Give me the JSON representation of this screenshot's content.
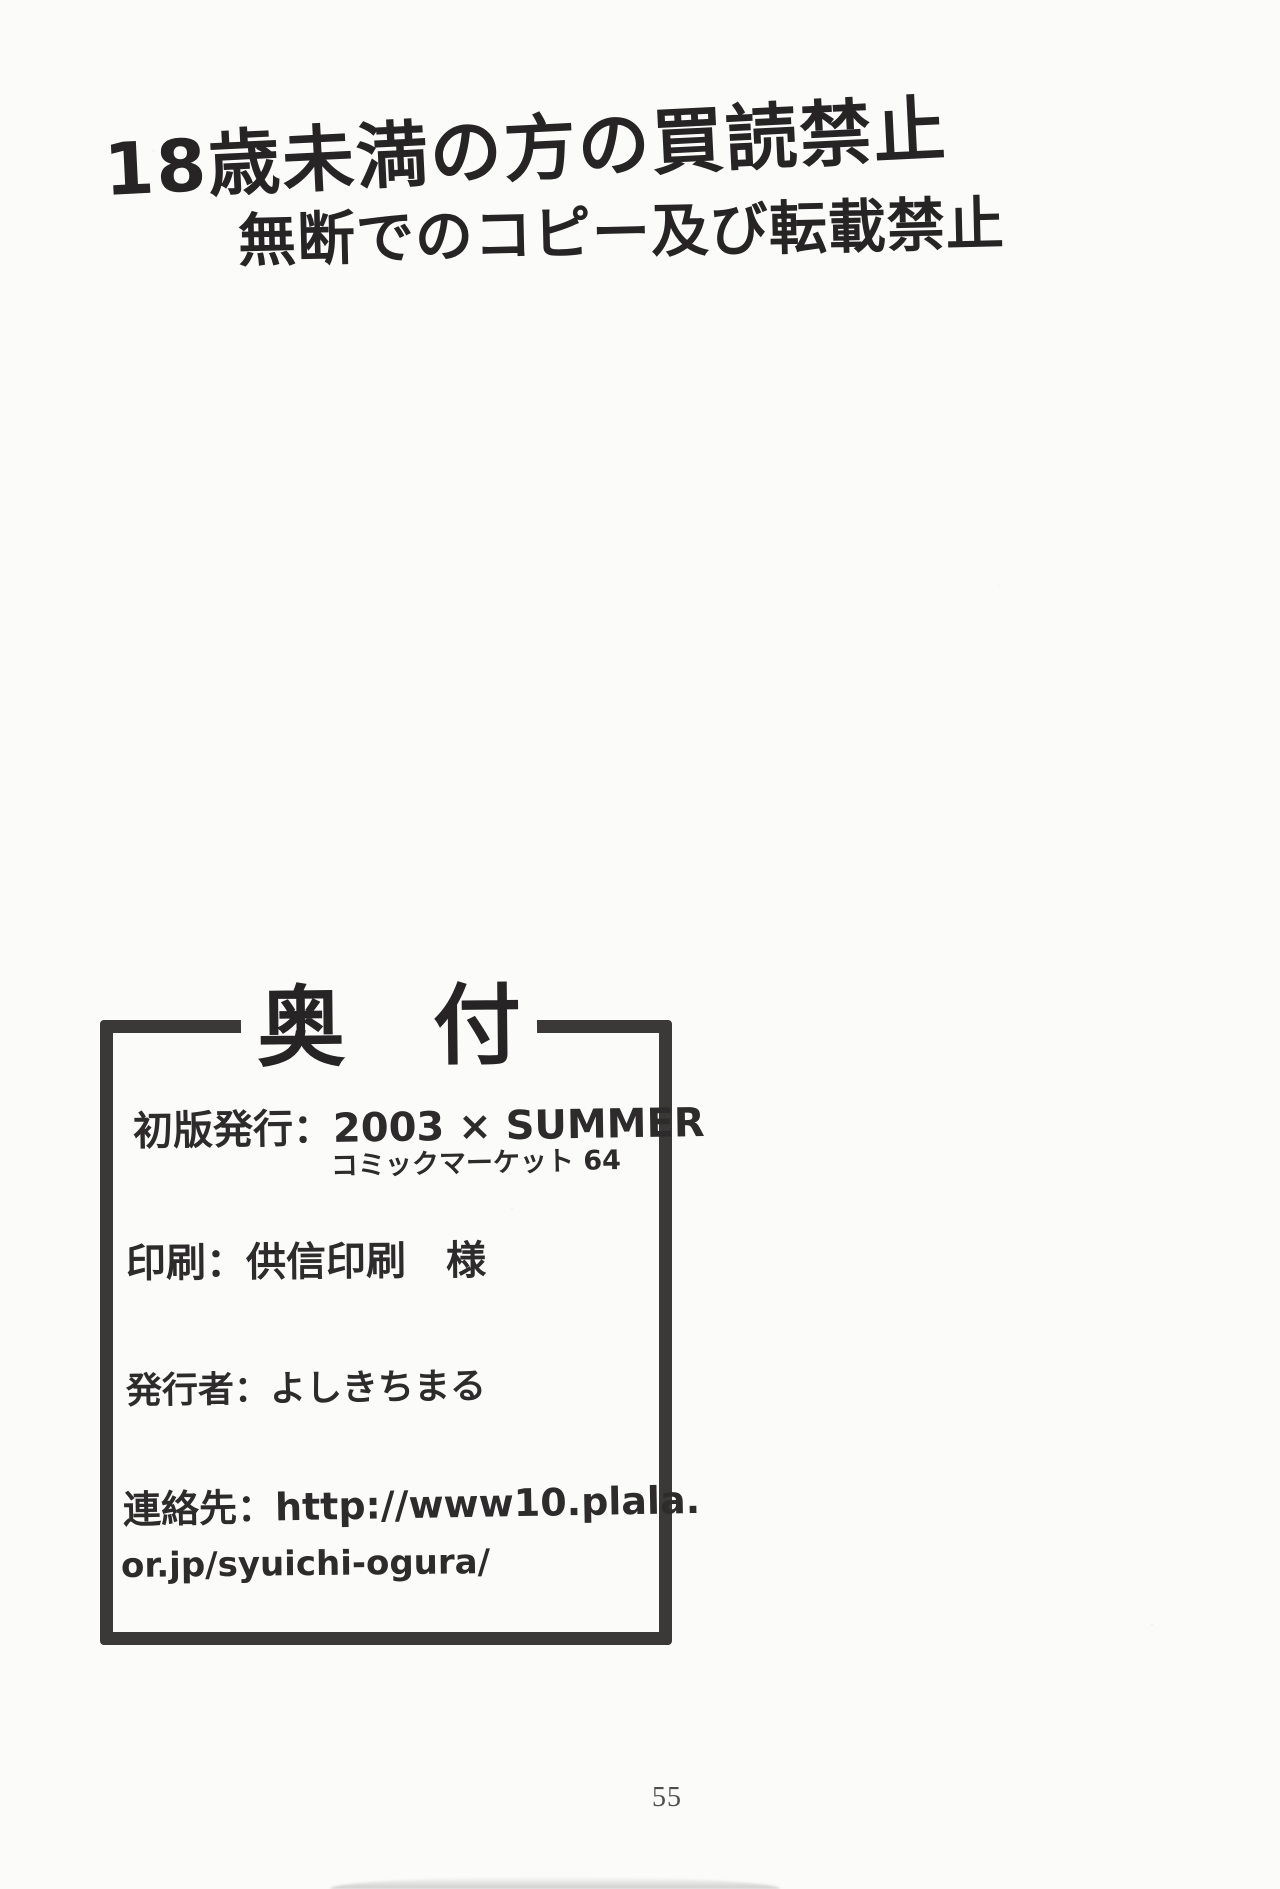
{
  "page": {
    "background": "#fbfbfa",
    "ink": "#262424"
  },
  "warning": {
    "line1": "18歳未満の方の買読禁止",
    "line2": "無断でのコピー及び転載禁止"
  },
  "colophon": {
    "title": "奥　付",
    "rows": [
      {
        "line1": "初版発行：2003 × SUMMER",
        "line2": "コミックマーケット 64"
      },
      {
        "line1": "印刷：供信印刷　様"
      },
      {
        "line1": "発行者：よしきちまる"
      },
      {
        "line1": "連絡先：http://www10.plala.",
        "line2": "or.jp/syuichi-ogura/"
      }
    ]
  },
  "footer": {
    "page_number": "55"
  }
}
